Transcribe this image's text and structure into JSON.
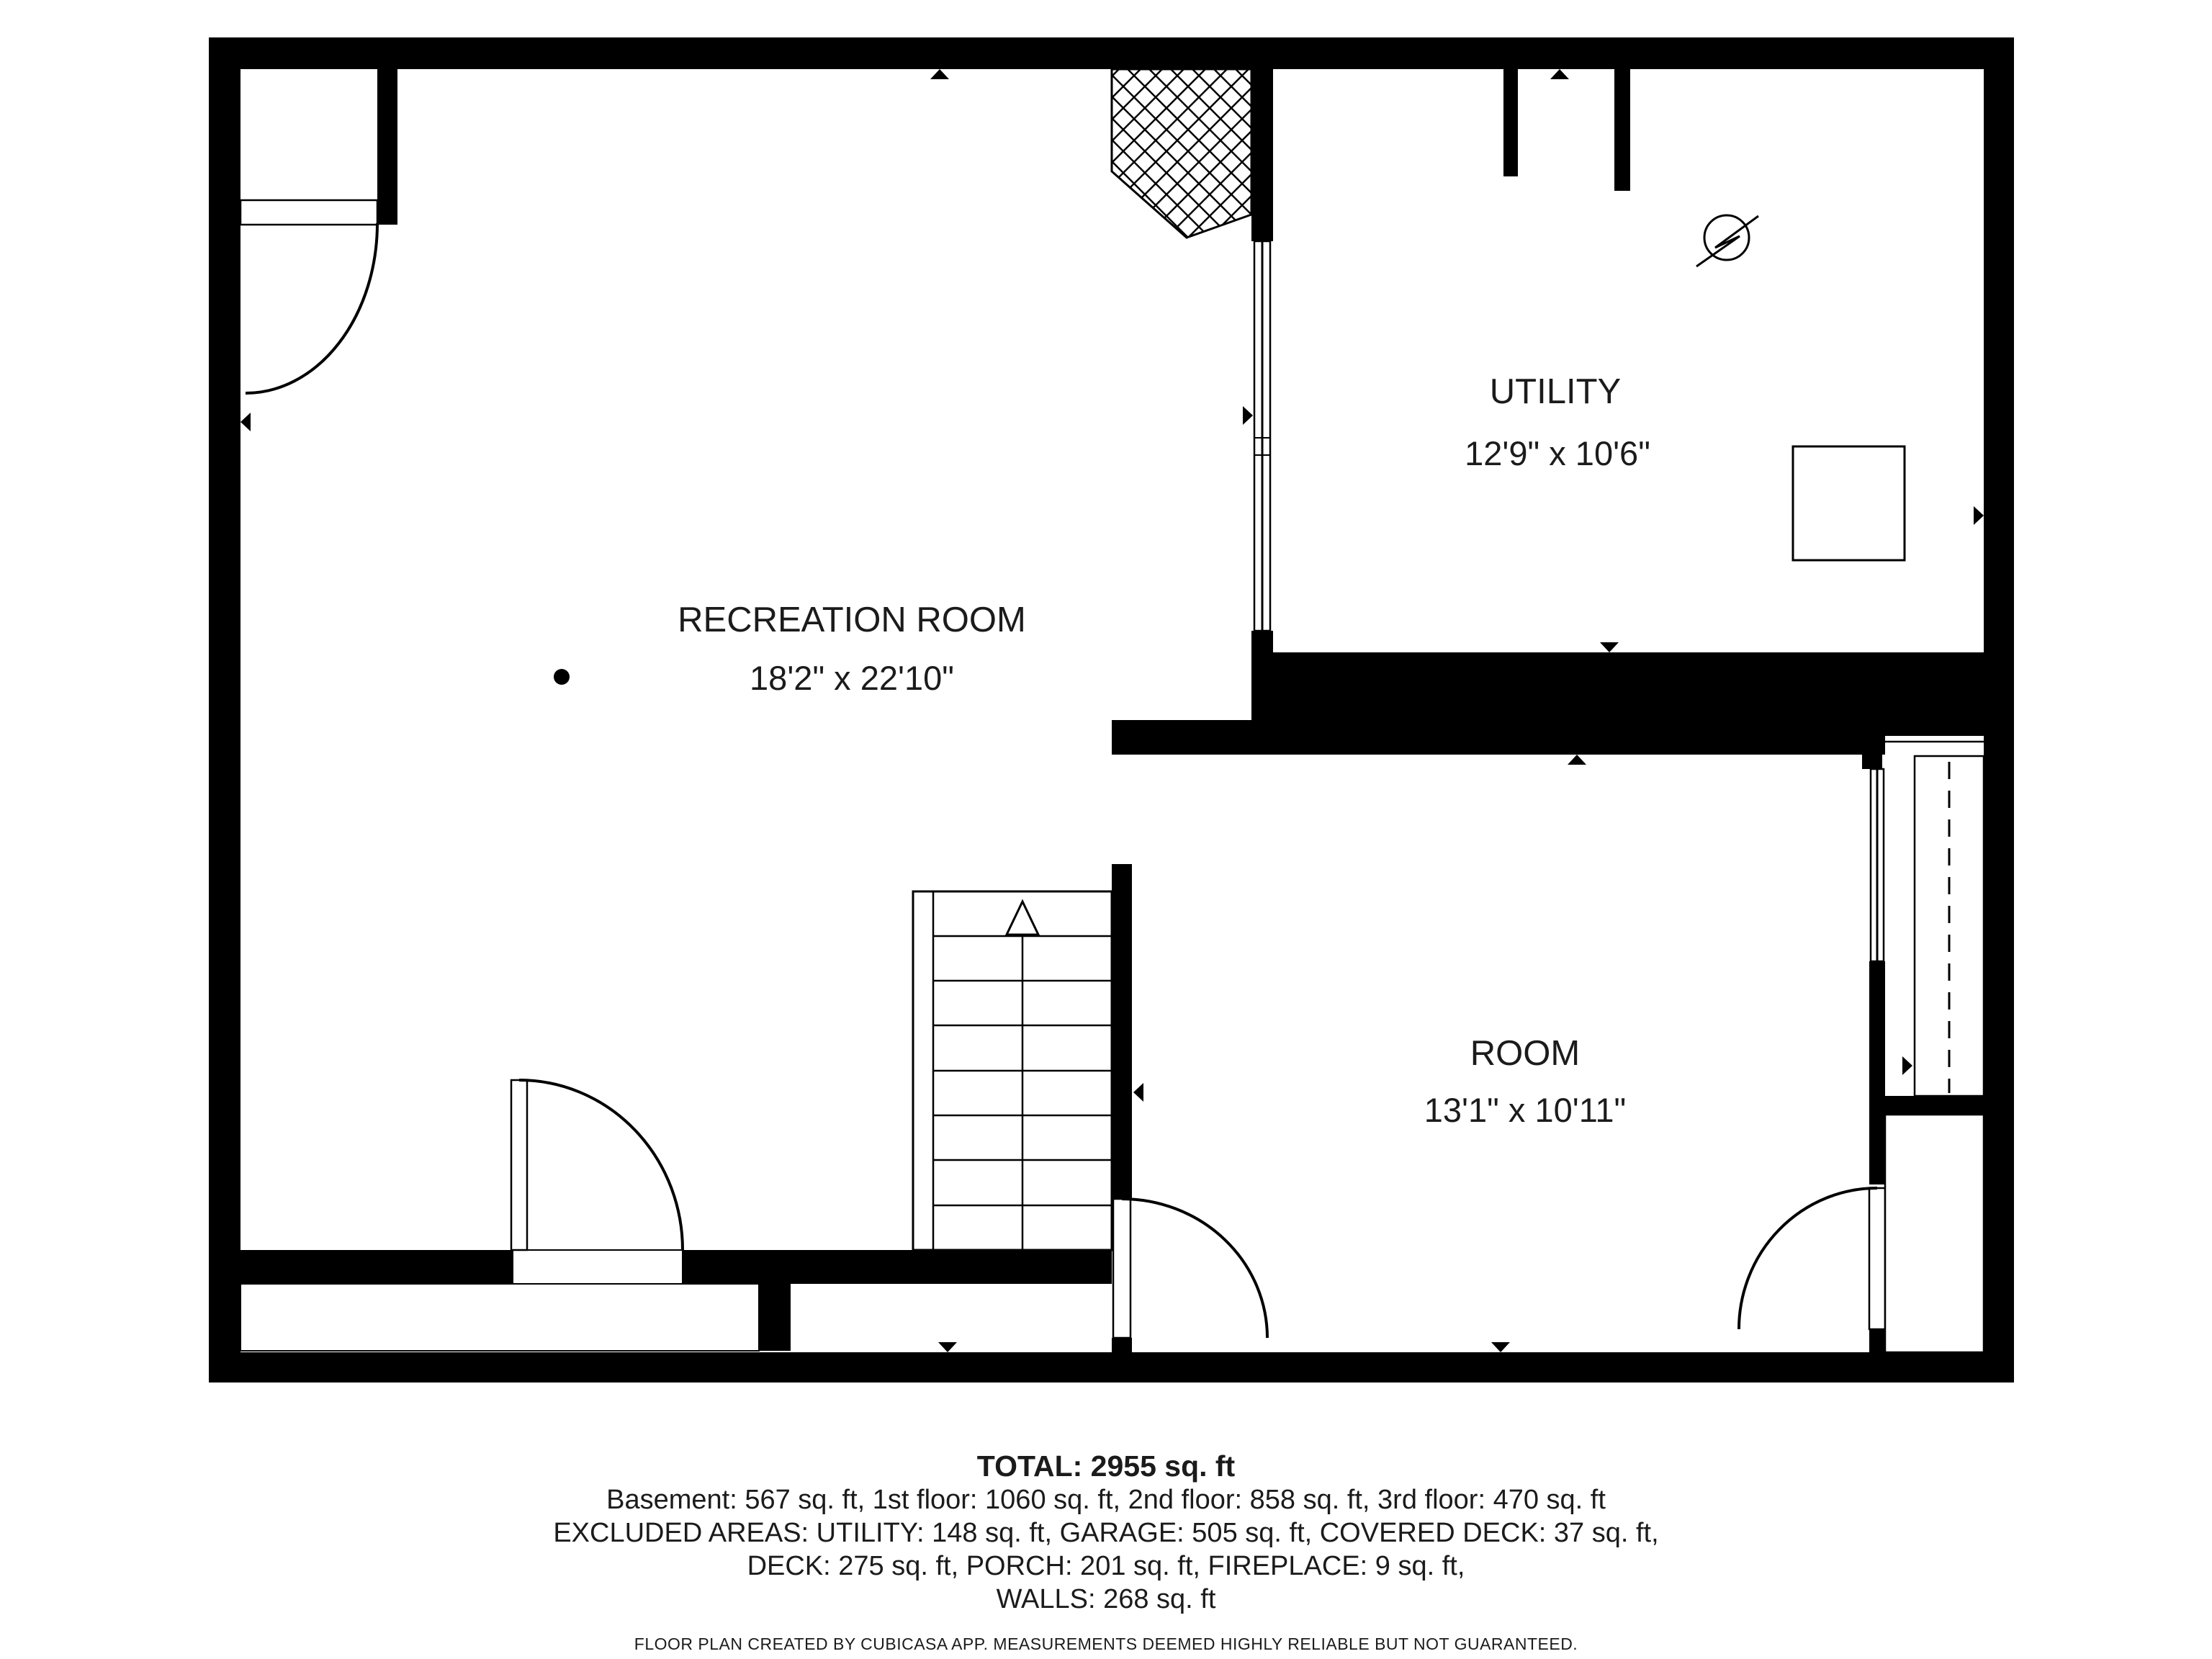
{
  "plan": {
    "rooms": [
      {
        "name": "RECREATION ROOM",
        "dims": "18'2\" x 22'10\""
      },
      {
        "name": "UTILITY",
        "dims": "12'9\" x 10'6\""
      },
      {
        "name": "ROOM",
        "dims": "13'1\" x 10'11\""
      }
    ],
    "icons": [
      "electric-meter-icon",
      "water-heater-box",
      "fireplace-hatch",
      "stairs-up-arrow",
      "camera-point-dot"
    ],
    "wall_color": "#000000",
    "background_color": "#ffffff"
  },
  "summary": {
    "total": "TOTAL: 2955 sq. ft",
    "floors": "Basement: 567 sq. ft, 1st floor: 1060 sq. ft, 2nd floor: 858 sq. ft, 3rd floor: 470 sq. ft",
    "excluded1": "EXCLUDED AREAS: UTILITY: 148 sq. ft, GARAGE: 505 sq. ft, COVERED DECK: 37 sq. ft,",
    "excluded2": "DECK: 275 sq. ft, PORCH: 201 sq. ft, FIREPLACE: 9 sq. ft,",
    "excluded3": "WALLS: 268 sq. ft"
  },
  "footer": "FLOOR PLAN CREATED BY CUBICASA APP. MEASUREMENTS DEEMED HIGHLY RELIABLE BUT NOT GUARANTEED."
}
